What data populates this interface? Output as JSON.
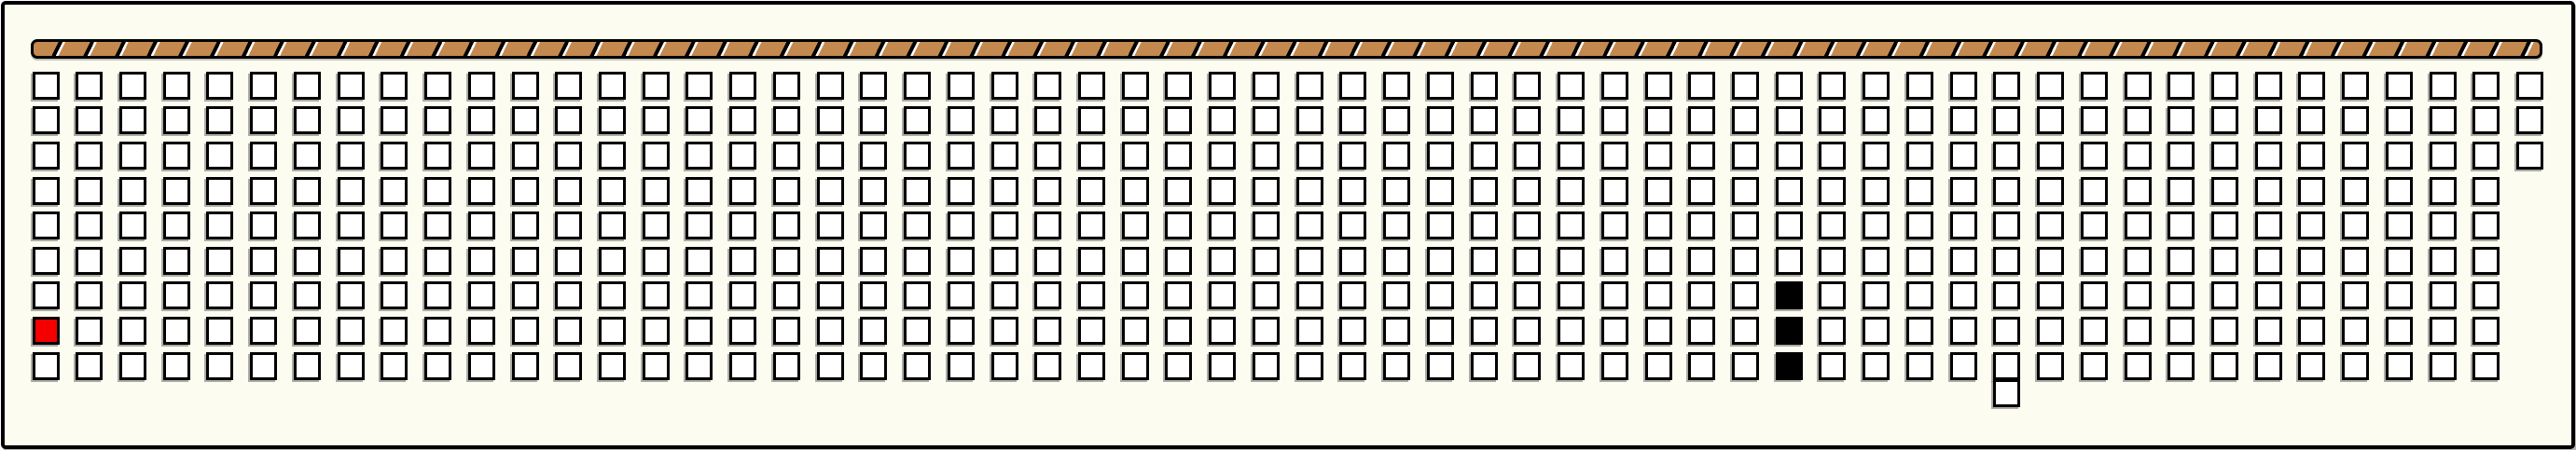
{
  "colors": {
    "panel_bg": "#FCFCF1",
    "line": "#000000",
    "square_fill": "#FFFFFF",
    "square_border": "#000000",
    "square_shadow": "rgba(105,105,105,0.55)",
    "red": "#F40000",
    "black_fill": "#000000",
    "bar_tan": "#C4894E",
    "bar_slash": "#FFFFFF"
  },
  "hatched_bar": {
    "kind": "diagonal-hatched-bar",
    "segments_lean": "forward-slash"
  },
  "grid": {
    "columns": 58,
    "rows": 9,
    "last_column": {
      "index": 57,
      "visible_rows": 3
    },
    "special_cells": [
      {
        "col": 0,
        "row": 7,
        "state": "red"
      },
      {
        "col": 40,
        "row": 6,
        "state": "black"
      },
      {
        "col": 40,
        "row": 7,
        "state": "black"
      },
      {
        "col": 40,
        "row": 8,
        "state": "black"
      }
    ],
    "detached_square": {
      "col": 45,
      "state": "empty",
      "position": "below-bottom-row"
    }
  }
}
